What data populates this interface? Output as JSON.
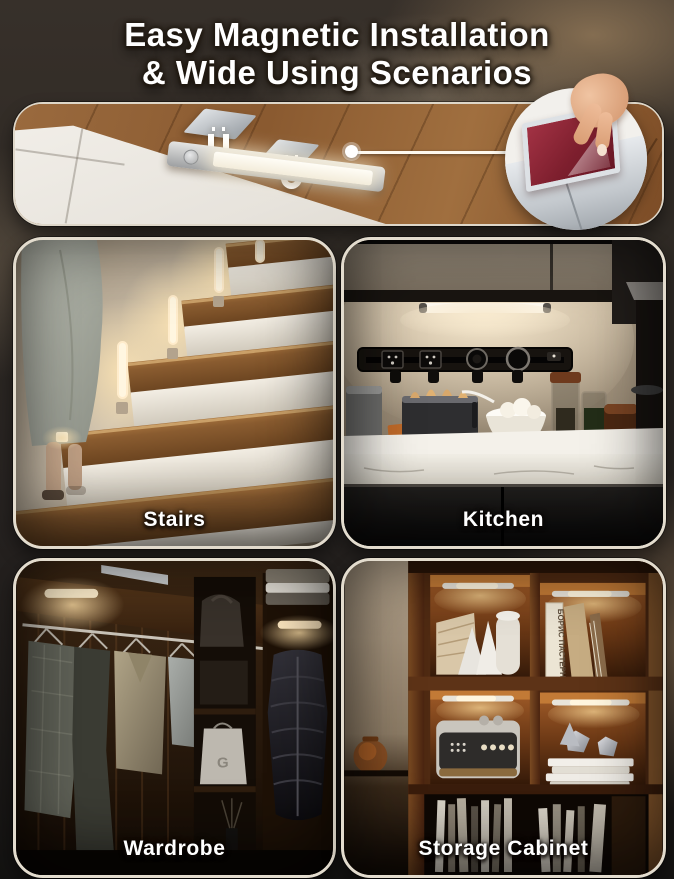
{
  "title": {
    "line1": "Easy Magnetic Installation",
    "line2": "& Wide Using Scenarios"
  },
  "panels": [
    {
      "id": "stairs",
      "label": "Stairs"
    },
    {
      "id": "kitchen",
      "label": "Kitchen"
    },
    {
      "id": "wardrobe",
      "label": "Wardrobe"
    },
    {
      "id": "storage-cabinet",
      "label": "Storage Cabinet"
    }
  ],
  "decor_text": {
    "book_spine": "БОРИС ПАСТЕРНАК",
    "bag_letter": "G"
  },
  "icons": {
    "magnet": "magnet-icon",
    "motion_sensor": "motion-sensor-icon",
    "callout_dot": "callout-dot",
    "hand": "hand-icon"
  },
  "colors": {
    "title_text": "#FFFFFF",
    "panel_border": "#E3DCCE",
    "warm_light": "#FFE9C2",
    "wood": "#8A5A34",
    "adhesive_pad": "#7E2130"
  }
}
